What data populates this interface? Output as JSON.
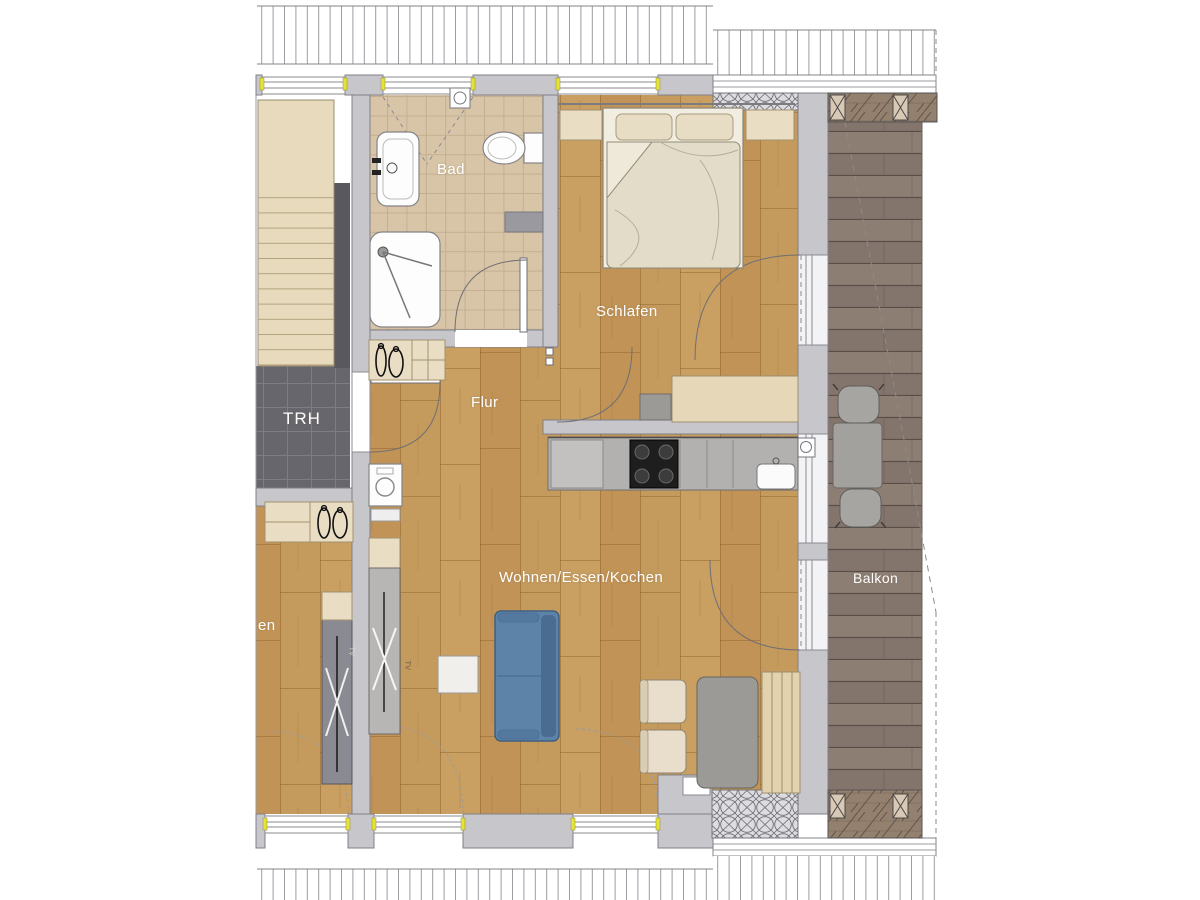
{
  "plan": {
    "type": "apartment-floor-plan",
    "rooms": [
      {
        "id": "trh",
        "label": "TRH"
      },
      {
        "id": "bad",
        "label": "Bad"
      },
      {
        "id": "flur",
        "label": "Flur"
      },
      {
        "id": "schlafen",
        "label": "Schlafen"
      },
      {
        "id": "wohnen",
        "label": "Wohnen/Essen/Kochen"
      },
      {
        "id": "balkon",
        "label": "Balkon"
      },
      {
        "id": "neighbor-fragment",
        "label": "en"
      }
    ],
    "furniture_labels": {
      "tv_left": "TV",
      "tv_right": "TV"
    },
    "colors": {
      "wood": "#c59a5d",
      "wood_joint": "#8a5f2a",
      "deck": "#8d7e74",
      "deck_line": "#594f47",
      "wall": "#c7c6cb",
      "wall_stroke": "#808089",
      "trh_floor": "#67666d",
      "trh_grid": "#7e7d84",
      "bath_tile": "#d8c5a7",
      "bath_grid": "#c3af90",
      "stairs": "#e8dbbd",
      "stair_line": "#c9b795",
      "furniture_beige": "#e9ddc3",
      "sofa_blue": "#5e83a8",
      "sofa_blue_dark": "#4a6c90",
      "kitchen_counter": "#b2b1af",
      "cooktop_black": "#1e1e1e",
      "dining_table_gray": "#9c9a96",
      "balcony_furniture": "#a7a5a2",
      "sideboard_gray": "#b7b6b4",
      "neighbor_sideboard_gray": "#8a8a92",
      "window_accent_yellow": "#e6e432",
      "roof_hatch_line": "#9b9ba1",
      "parapet_wood": "#93806f",
      "label_text": "#ffffff"
    }
  }
}
